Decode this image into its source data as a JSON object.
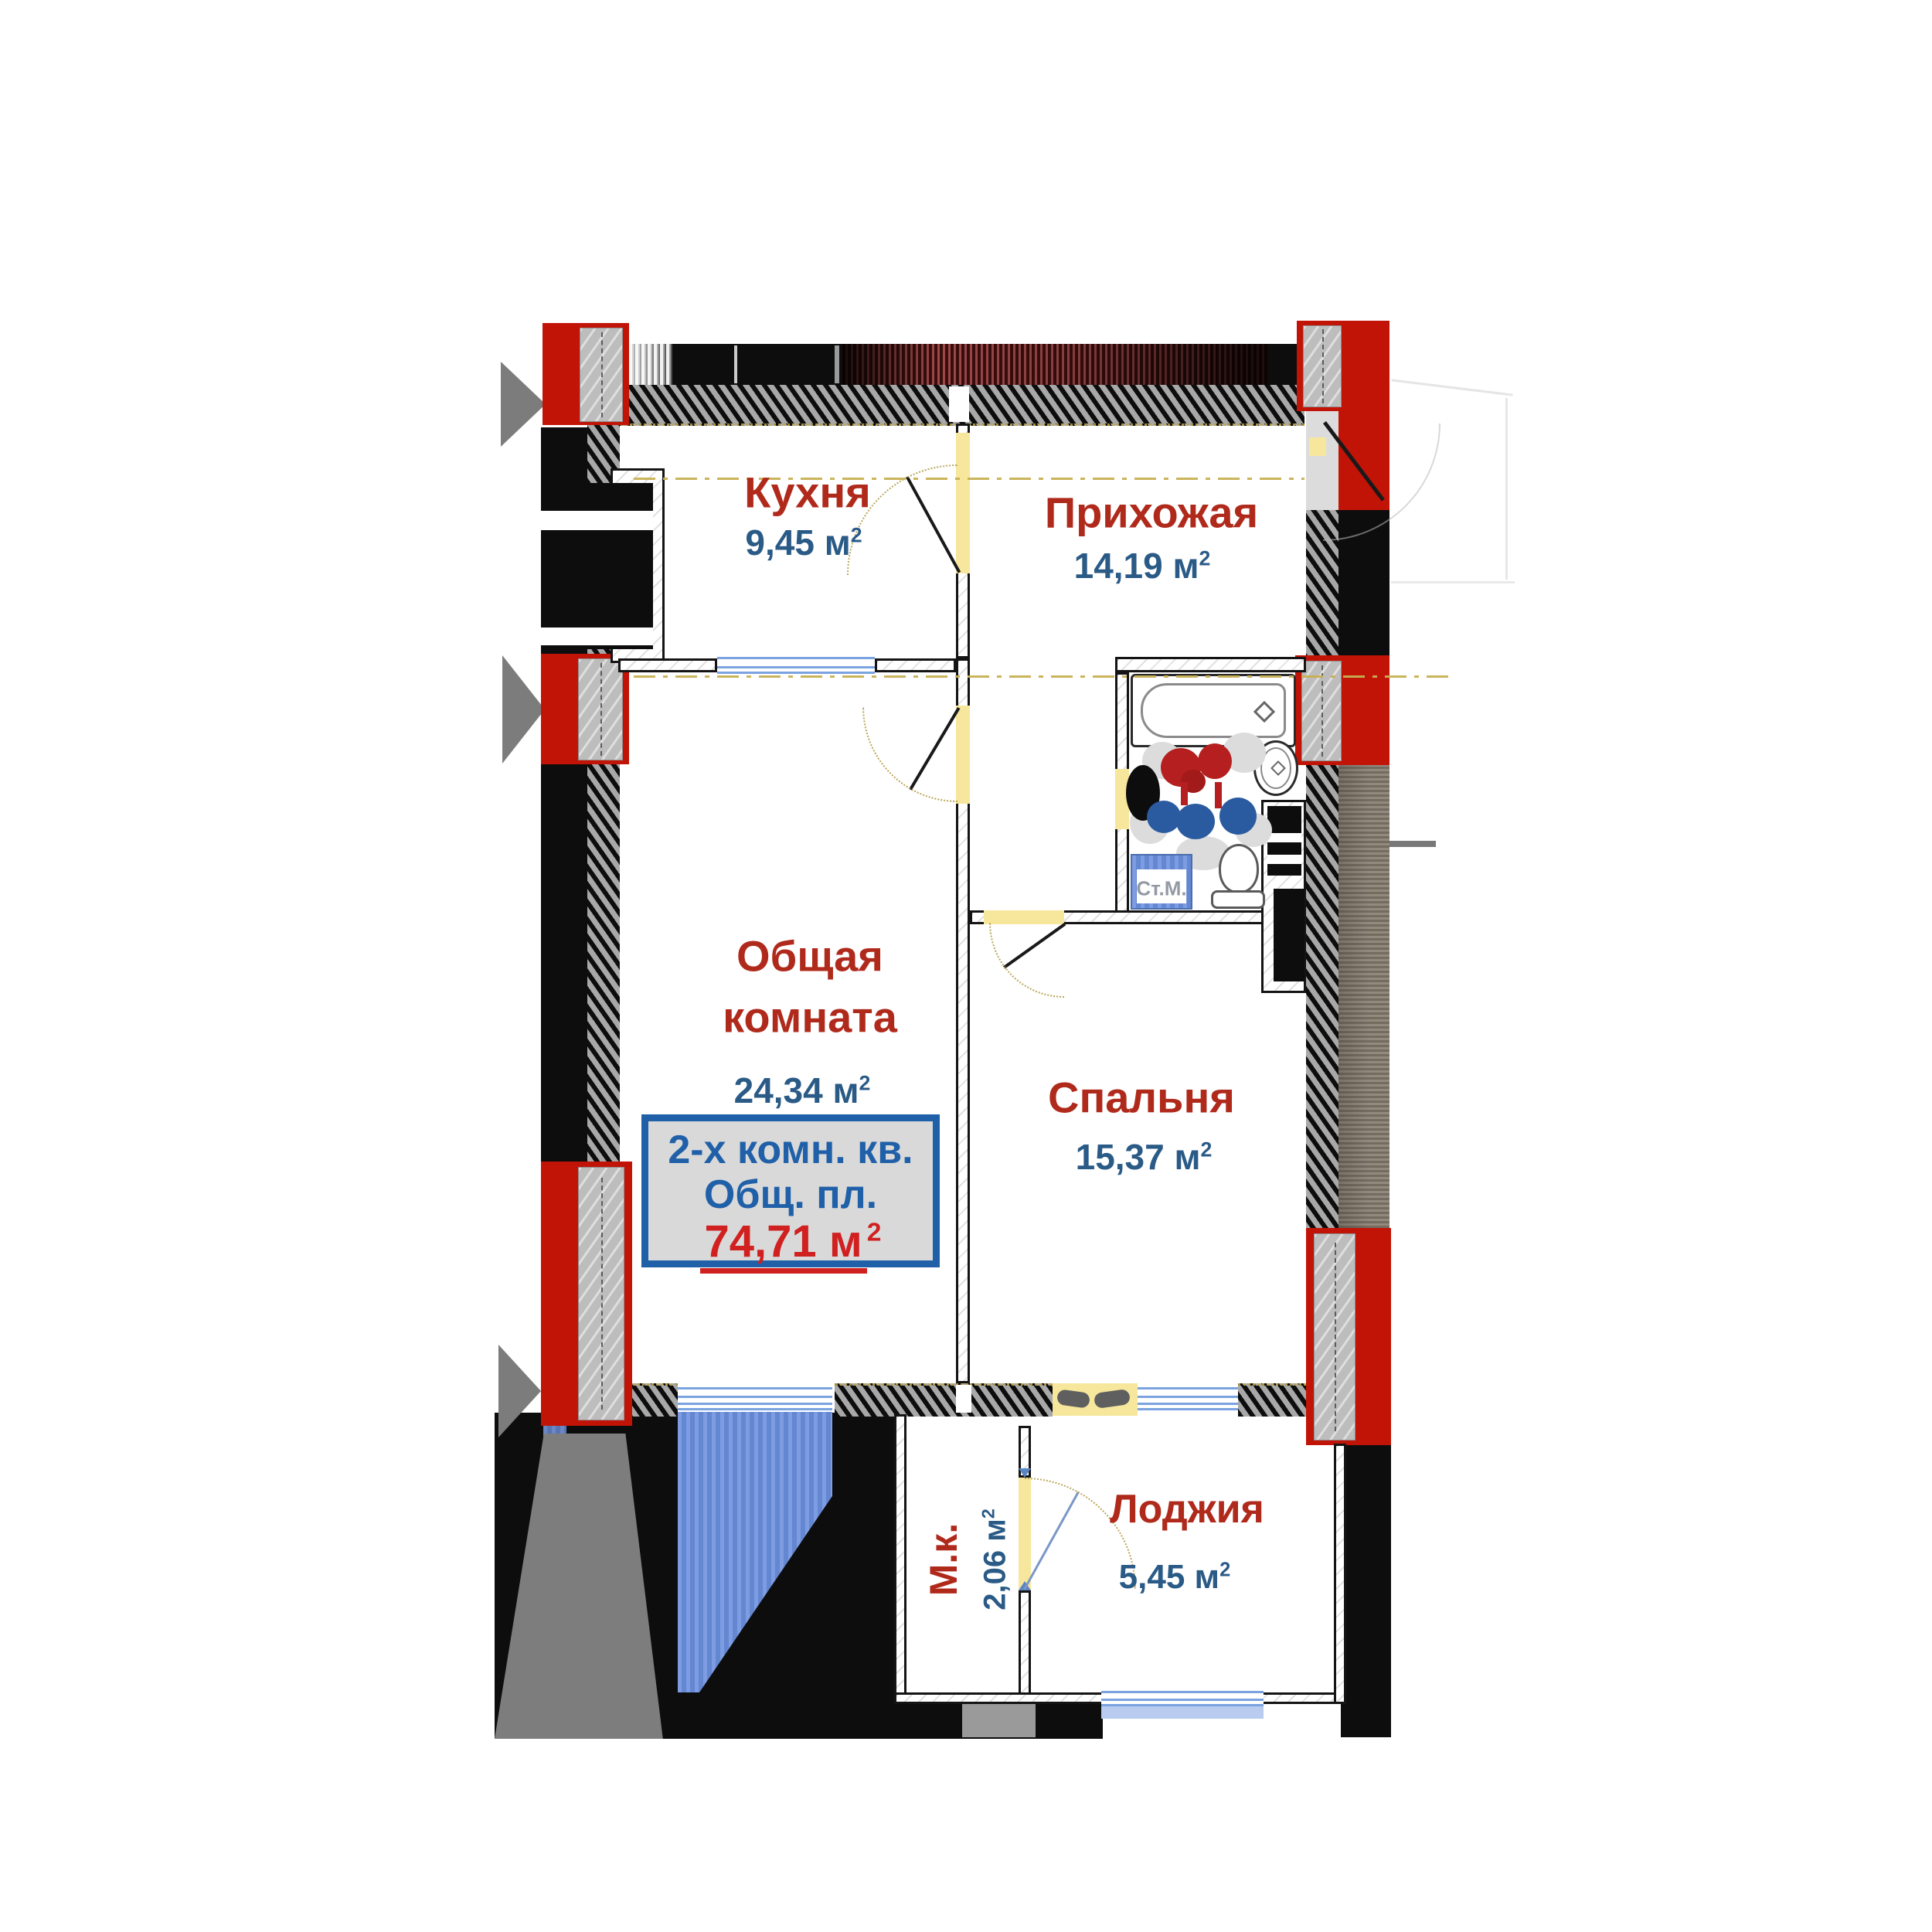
{
  "units": {
    "m": "м",
    "sup": "2"
  },
  "rooms": {
    "kitchen": {
      "name": "Кухня",
      "area": "9,45"
    },
    "hallway": {
      "name": "Прихожая",
      "area": "14,19"
    },
    "living": {
      "name_line1": "Общая",
      "name_line2": "комната",
      "area": "24,34"
    },
    "bedroom": {
      "name": "Спальня",
      "area": "15,37"
    },
    "loggia": {
      "name": "Лоджия",
      "area": "5,45"
    },
    "small_room": {
      "name": "М.к.",
      "area": "2,06"
    }
  },
  "info_box": {
    "line1": "2-х комн. кв.",
    "line2": "Общ. пл.",
    "area_value": "74,71"
  },
  "fixtures": {
    "washing_machine_label": "Ст.М."
  },
  "colors": {
    "wall_black": "#0d0d0d",
    "hatch_gray": "#a8a8a8",
    "red_block": "#c11407",
    "column_gray": "#bdbdbd",
    "door_yellow": "#f6e79c",
    "axis_yellow": "#c7b054",
    "window_blue": "#7aa3e0",
    "neighbor_area_blue": "#6e8fd8",
    "label_red": "#b02a1c",
    "label_blue": "#2a5a86",
    "info_border_blue": "#2060a8",
    "info_bg": "#d9d9d9",
    "value_red": "#d02020",
    "band_dark_red": "#9c4848",
    "band_brown": "#8b8174",
    "washing_machine_text": "#939aa3"
  }
}
